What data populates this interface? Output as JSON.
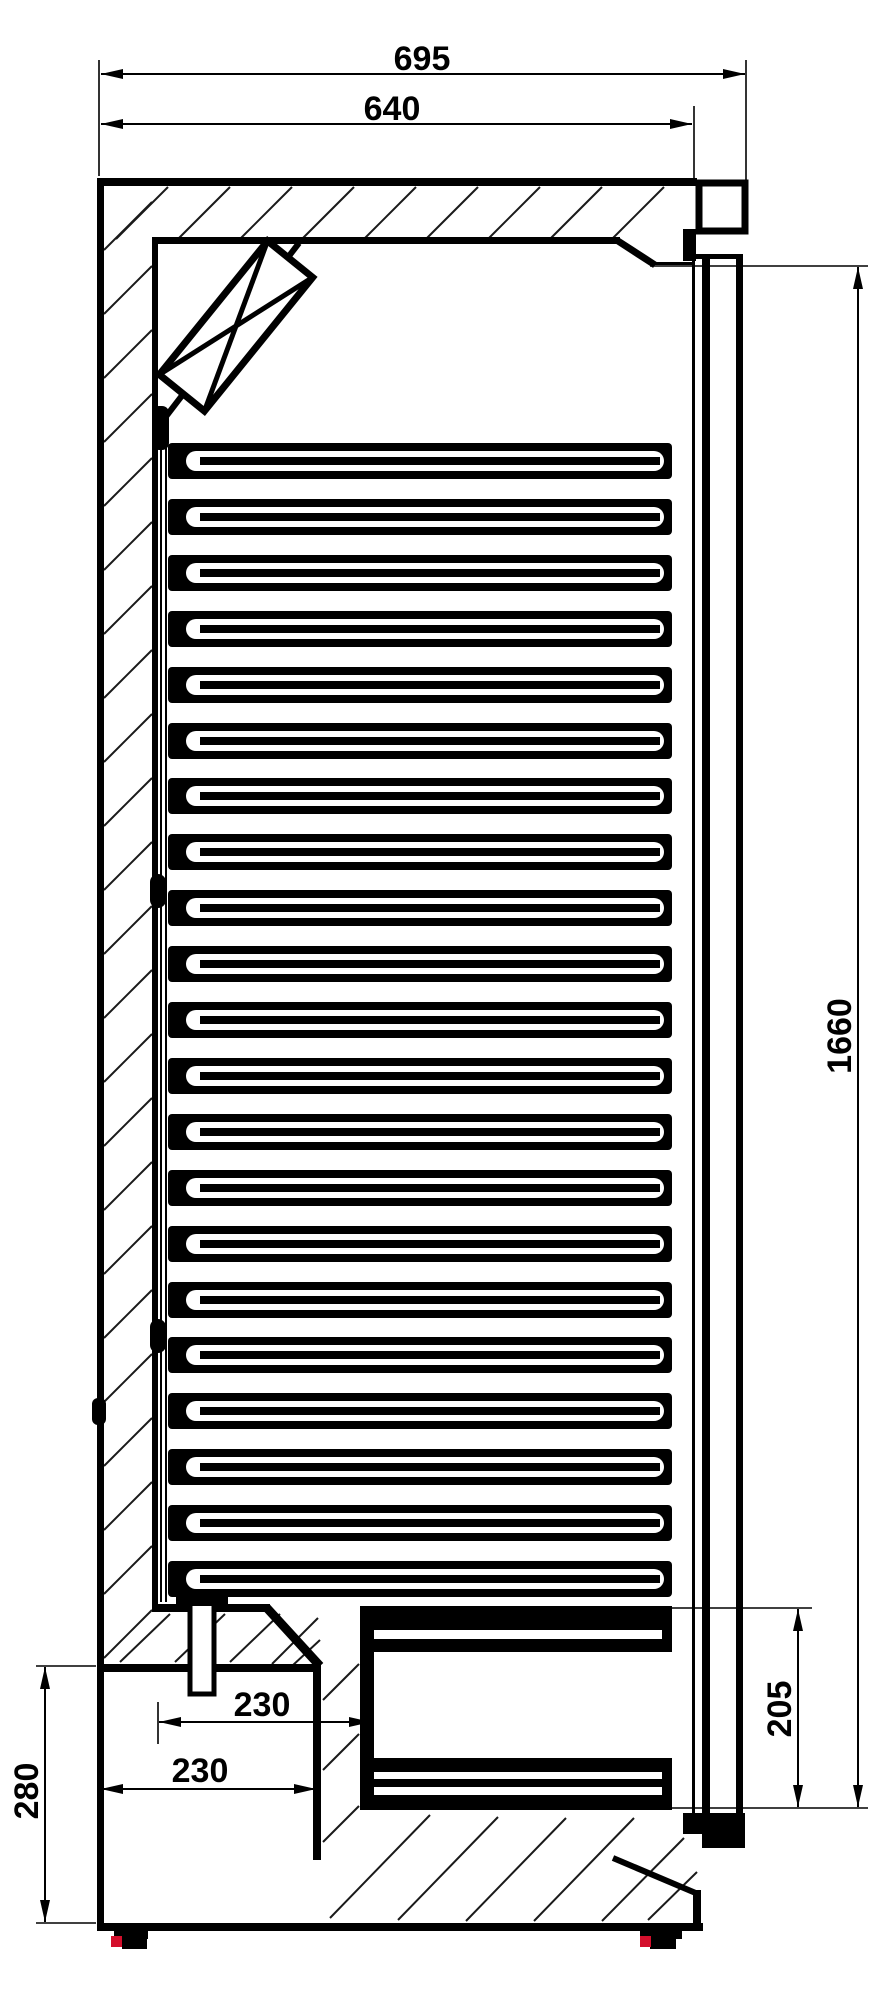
{
  "drawing": {
    "type": "technical-dimension-drawing",
    "view": "side-section",
    "subject": "refrigerated-cabinet-with-evaporator-shelves",
    "units": "mm"
  },
  "dimensions": {
    "width_outer": {
      "value": "695"
    },
    "width_inner": {
      "value": "640"
    },
    "height_door": {
      "value": "1660"
    },
    "height_evap_bottom": {
      "value": "205"
    },
    "height_base": {
      "value": "280"
    },
    "depth_step_upper": {
      "value": "230"
    },
    "depth_step_lower": {
      "value": "230"
    }
  },
  "components": {
    "shelf_count": 21
  },
  "colors": {
    "line": "#000000",
    "background": "#ffffff",
    "foot_accent": "#d40f2c"
  }
}
